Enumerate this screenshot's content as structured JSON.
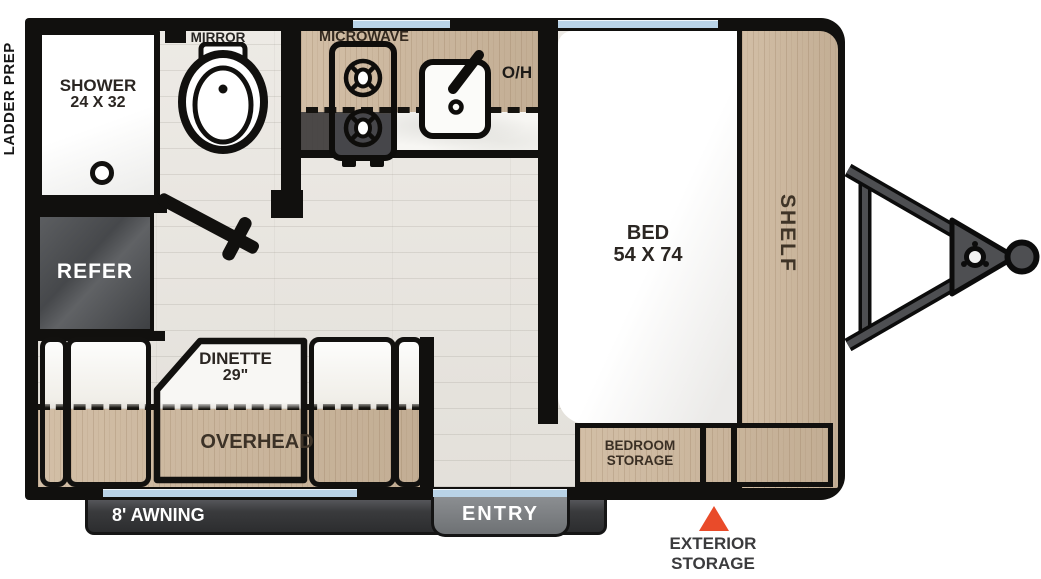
{
  "exterior": {
    "ladder_prep_label": "LADDER PREP",
    "awning_label": "8' AWNING",
    "entry_label": "ENTRY",
    "exterior_storage_label_line1": "EXTERIOR",
    "exterior_storage_label_line2": "STORAGE"
  },
  "bathroom": {
    "shower_label": "SHOWER",
    "shower_size": "24 X 32",
    "mirror_label": "MIRROR"
  },
  "kitchen": {
    "microwave_label": "MICROWAVE",
    "overhead_label": "O/H",
    "refer_label": "REFER"
  },
  "dinette": {
    "name_label": "DINETTE",
    "size_label": "29\"",
    "overhead_label": "OVERHEAD"
  },
  "bedroom": {
    "bed_label": "BED",
    "bed_size": "54 X 74",
    "shelf_label": "SHELF",
    "storage_label_line1": "BEDROOM",
    "storage_label_line2": "STORAGE"
  },
  "colors": {
    "wall_black": "#11100e",
    "cabinet_wood": "#cdb79c",
    "floor_wood": "#e9e6e0",
    "window_blue": "#b9d3e7",
    "hitch_metal": "#4e4f52",
    "refer_gray": "#4a4c4f",
    "marker_orange": "#e94b2a",
    "awning_bar_gray": "#3b3c3e",
    "entry_tab_gray": "#7c7f82",
    "counter_marble": "#f7f6f3"
  },
  "icons": {
    "toilet": "toilet-icon",
    "cooktop": "cooktop-icon",
    "sink": "sink-icon",
    "faucet": "faucet-icon",
    "shower_drain": "drain-icon",
    "door_swing": "door-swing-icon",
    "hitch": "hitch-icon",
    "exterior_storage_marker": "triangle-marker-icon",
    "window": "window-strip"
  }
}
